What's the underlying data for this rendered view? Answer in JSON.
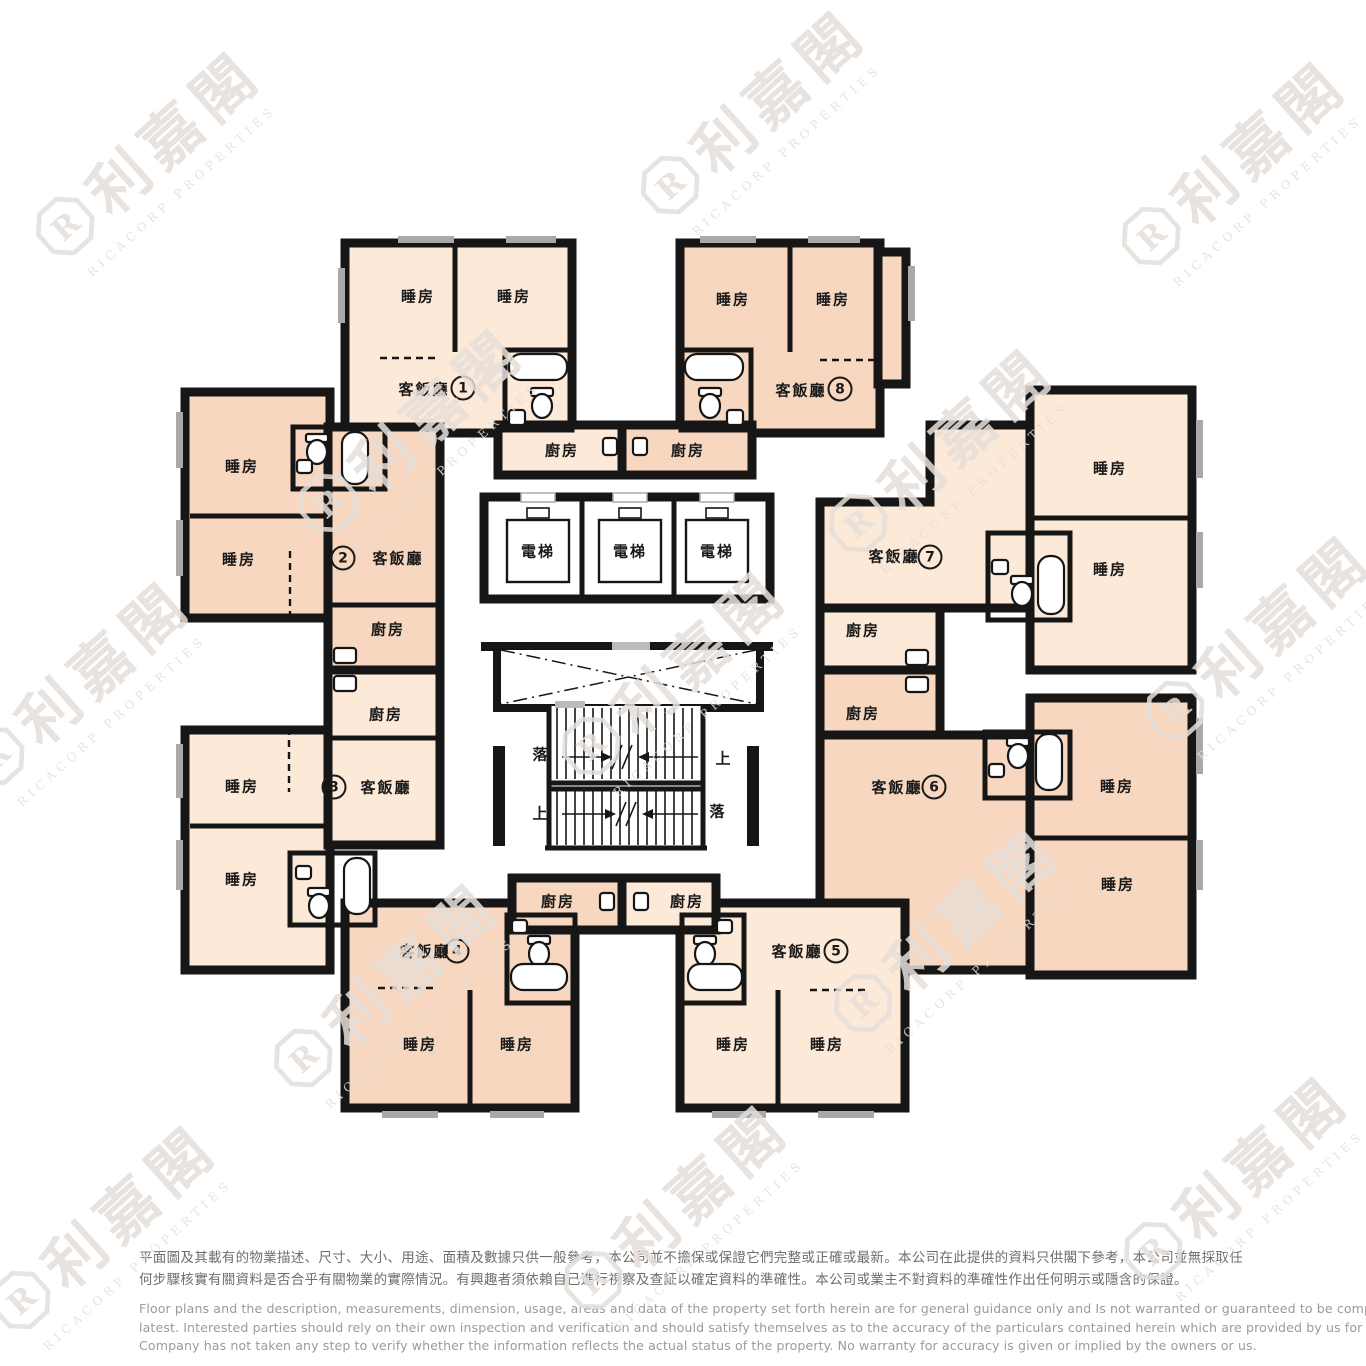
{
  "brand": {
    "name_zh": "利嘉閣",
    "name_en": "RICACORP PROPERTIES"
  },
  "plan": {
    "units": [
      {
        "no": "1",
        "living": "客飯廳",
        "kitchen": "廚房",
        "bedrooms": [
          "睡房",
          "睡房"
        ]
      },
      {
        "no": "2",
        "living": "客飯廳",
        "kitchen": "廚房",
        "bedrooms": [
          "睡房",
          "睡房"
        ]
      },
      {
        "no": "3",
        "living": "客飯廳",
        "kitchen": "廚房",
        "bedrooms": [
          "睡房",
          "睡房"
        ]
      },
      {
        "no": "4",
        "living": "客飯廳",
        "kitchen": "廚房",
        "bedrooms": [
          "睡房",
          "睡房"
        ]
      },
      {
        "no": "5",
        "living": "客飯廳",
        "kitchen": "廚房",
        "bedrooms": [
          "睡房",
          "睡房"
        ]
      },
      {
        "no": "6",
        "living": "客飯廳",
        "kitchen": "廚房",
        "bedrooms": [
          "睡房",
          "睡房"
        ]
      },
      {
        "no": "7",
        "living": "客飯廳",
        "kitchen": "廚房",
        "bedrooms": [
          "睡房",
          "睡房"
        ]
      },
      {
        "no": "8",
        "living": "客飯廳",
        "kitchen": "廚房",
        "bedrooms": [
          "睡房",
          "睡房"
        ]
      }
    ],
    "core": {
      "elevators": [
        "電梯",
        "電梯",
        "電梯"
      ],
      "stairs": {
        "up": "上",
        "down": "落"
      }
    }
  },
  "colors": {
    "unit_light": "#fce9d8",
    "unit_dark": "#f7d7bf",
    "wall": "#161616",
    "window": "#a9a9a9",
    "watermark": "#e5dfda"
  },
  "disclaimer": {
    "zh": [
      "平面圖及其載有的物業描述、尺寸、大小、用途、面積及數據只供一般參考，本公司並不擔保或保證它們完整或正確或最新。本公司在此提供的資料只供閣下參考，本公司並無採取任",
      "何步驟核實有關資料是否合乎有關物業的實際情況。有興趣者須依賴自己進行視察及查証以確定資料的準確性。本公司或業主不對資料的準確性作出任何明示或隱含的保證。"
    ],
    "en": [
      "Floor plans and the description, measurements, dimension, usage, areas and data of the property set forth herein are for general guidance only and Is not warranted or guaranteed to be complete or correct or the",
      "latest. Interested parties should rely on their own inspection and verification and should satisfy themselves as to the accuracy of the particulars contained herein which are provided by us for information only.  Our",
      "Company has not taken any step to verify whether the information reflects the actual status of the property.  No warranty for accuracy is given or implied by the owners or us."
    ]
  }
}
